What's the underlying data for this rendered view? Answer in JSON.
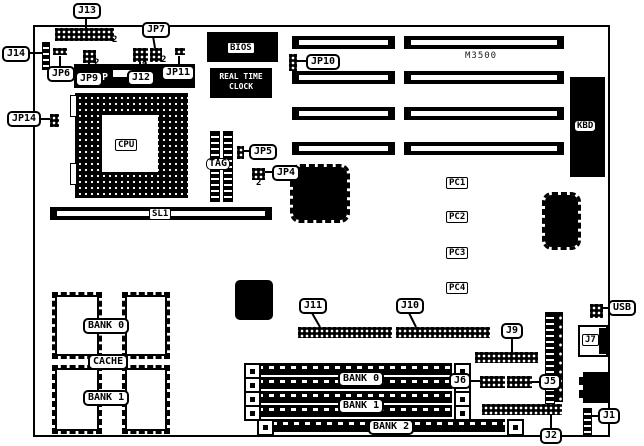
{
  "colors": {
    "ink": "#000000",
    "paper": "#ffffff"
  },
  "board_label": "M3500",
  "callouts": {
    "j13": "J13",
    "jp7": "JP7",
    "j14": "J14",
    "jp6": "JP6",
    "jp9": "JP9",
    "j12": "J12",
    "jp11": "JP11",
    "jp14": "JP14",
    "jp10": "JP10",
    "jp5": "JP5",
    "jp4": "JP4",
    "j11": "J11",
    "j10": "J10",
    "j9": "J9",
    "j6": "J6",
    "j5": "J5",
    "j7": "J7",
    "usb": "USB",
    "j1": "J1",
    "j2": "J2"
  },
  "chips": {
    "bios": "BIOS",
    "rtc_line1": "REAL TIME",
    "rtc_line2": "CLOCK",
    "cpu": "CPU",
    "tag": "TAG",
    "kbd": "KBD",
    "p_marking": "P"
  },
  "slots": {
    "sl1": "SL1",
    "pc1": "PC1",
    "pc2": "PC2",
    "pc3": "PC3",
    "pc4": "PC4"
  },
  "memory": {
    "cache_bank0": "BANK 0",
    "cache_label": "CACHE",
    "cache_bank1": "BANK 1",
    "simm_bank0": "BANK 0",
    "simm_bank1": "BANK 1",
    "simm_bank2": "BANK 2"
  },
  "pin_annotations": {
    "j13": "2",
    "jp7": "2",
    "jp9": "2",
    "j12": "4",
    "jp4": "2"
  }
}
